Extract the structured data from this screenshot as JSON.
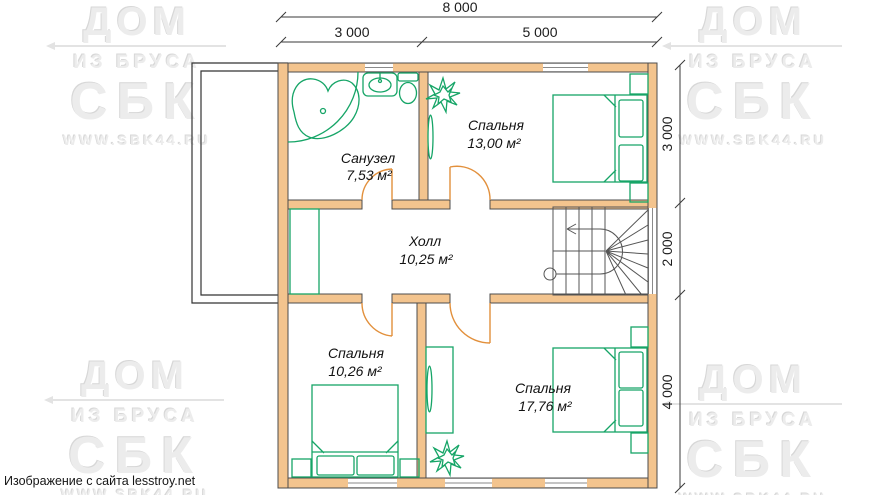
{
  "watermark": {
    "line1": "ДОМ",
    "line2": "ИЗ БРУСА",
    "line3": "СБК",
    "line4": "WWW.SBK44.RU"
  },
  "credit": "Изображение с сайта lesstroy.net",
  "dimensions": {
    "top_total": "8 000",
    "top_seg1": "3 000",
    "top_seg2": "5 000",
    "right_seg1": "3 000",
    "right_seg2": "2 000",
    "right_seg3": "4 000"
  },
  "rooms": {
    "bathroom": {
      "name": "Санузел",
      "area": "7,53 м²"
    },
    "bedroom_top": {
      "name": "Спальня",
      "area": "13,00 м²"
    },
    "hall": {
      "name": "Холл",
      "area": "10,25 м²"
    },
    "bedroom_bottom_left": {
      "name": "Спальня",
      "area": "10,26 м²"
    },
    "bedroom_bottom_right": {
      "name": "Спальня",
      "area": "17,76 м²"
    }
  },
  "colors": {
    "wall-fill": "#f3c48e",
    "wall-stroke": "#4c4c4c",
    "furniture": "#16a567",
    "door": "#e2903c",
    "line": "#3a3a3a",
    "stair": "#555555",
    "watermark": "#ececec"
  }
}
